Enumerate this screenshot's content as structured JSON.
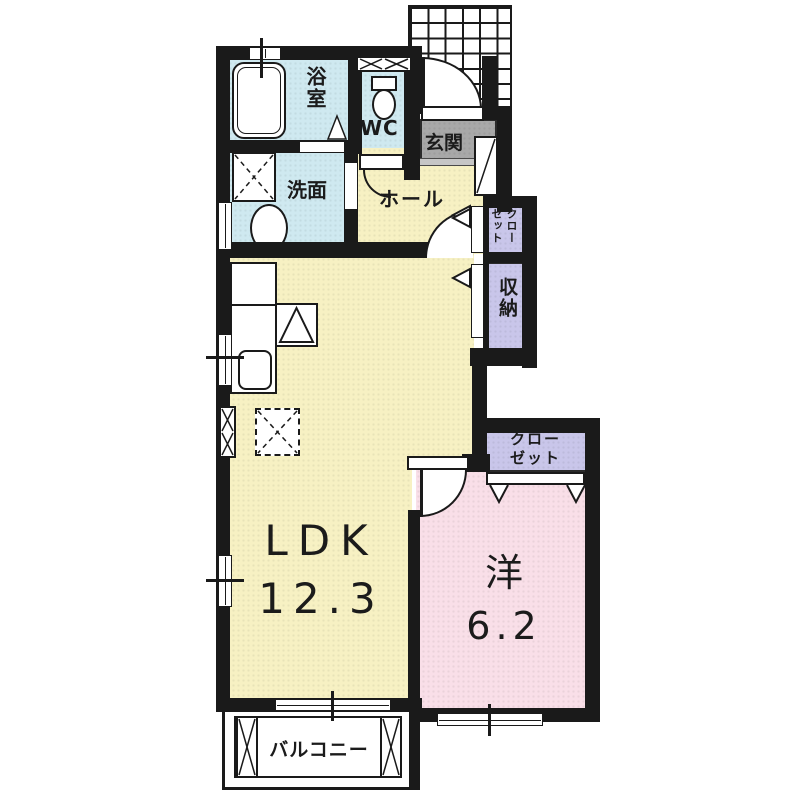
{
  "plan_title": "1LDK floor plan",
  "rooms": {
    "bath": {
      "label": "浴室"
    },
    "wc": {
      "label": "WC"
    },
    "washroom": {
      "label": "洗面"
    },
    "entrance": {
      "label": "玄関"
    },
    "hall": {
      "label": "ホール"
    },
    "closet_hall": {
      "label": "クローゼット"
    },
    "storage": {
      "label": "収納"
    },
    "ldk": {
      "label": "LDK",
      "size": "12.3"
    },
    "western": {
      "label": "洋",
      "size": "6.2"
    },
    "closet_western": {
      "line1": "クロー",
      "line2": "ゼット"
    },
    "balcony": {
      "label": "バルコニー"
    }
  },
  "colors": {
    "wall": "#1a1a1a",
    "wet_area": "#cfe9f0",
    "living": "#f7f1c3",
    "bedroom": "#f9dfe8",
    "closet": "#c9c6ea",
    "entrance_floor": "#a8a8a8"
  },
  "symbols": {
    "bathtub": "bathtub-icon",
    "toilet": "toilet-icon",
    "washing_machine": "washing-machine-space-icon",
    "wash_basin": "wash-basin-icon",
    "kitchen_counter": "kitchen-counter-icon",
    "stove": "stove-triangle-icon",
    "sink": "kitchen-sink-icon",
    "refrigerator": "refrigerator-space-icon",
    "shoe_cabinet": "shoe-cabinet-icon",
    "porch_tiles": "entrance-porch-tile-grid",
    "balcony_panels": "balcony-partition-x"
  }
}
